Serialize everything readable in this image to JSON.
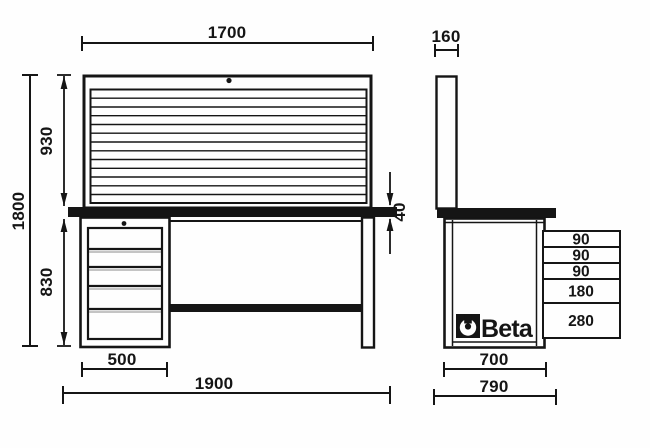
{
  "drawing": {
    "title": "Beta workbench dimensional drawing",
    "brand": "Beta",
    "front_view": {
      "dims": {
        "top_width": "1700",
        "panel_height": "930",
        "total_height": "1800",
        "under_height": "830",
        "worktop_thickness": "40",
        "cabinet_width": "500",
        "overall_width": "1900"
      }
    },
    "side_view": {
      "dims": {
        "panel_depth": "160",
        "body_depth": "700",
        "overall_depth": "790"
      },
      "drawer_rows": [
        {
          "height_label": "90"
        },
        {
          "height_label": "90"
        },
        {
          "height_label": "90"
        },
        {
          "height_label": "180"
        },
        {
          "height_label": "280"
        }
      ]
    },
    "colors": {
      "ink": "#151515",
      "paper": "#fefefe"
    }
  }
}
